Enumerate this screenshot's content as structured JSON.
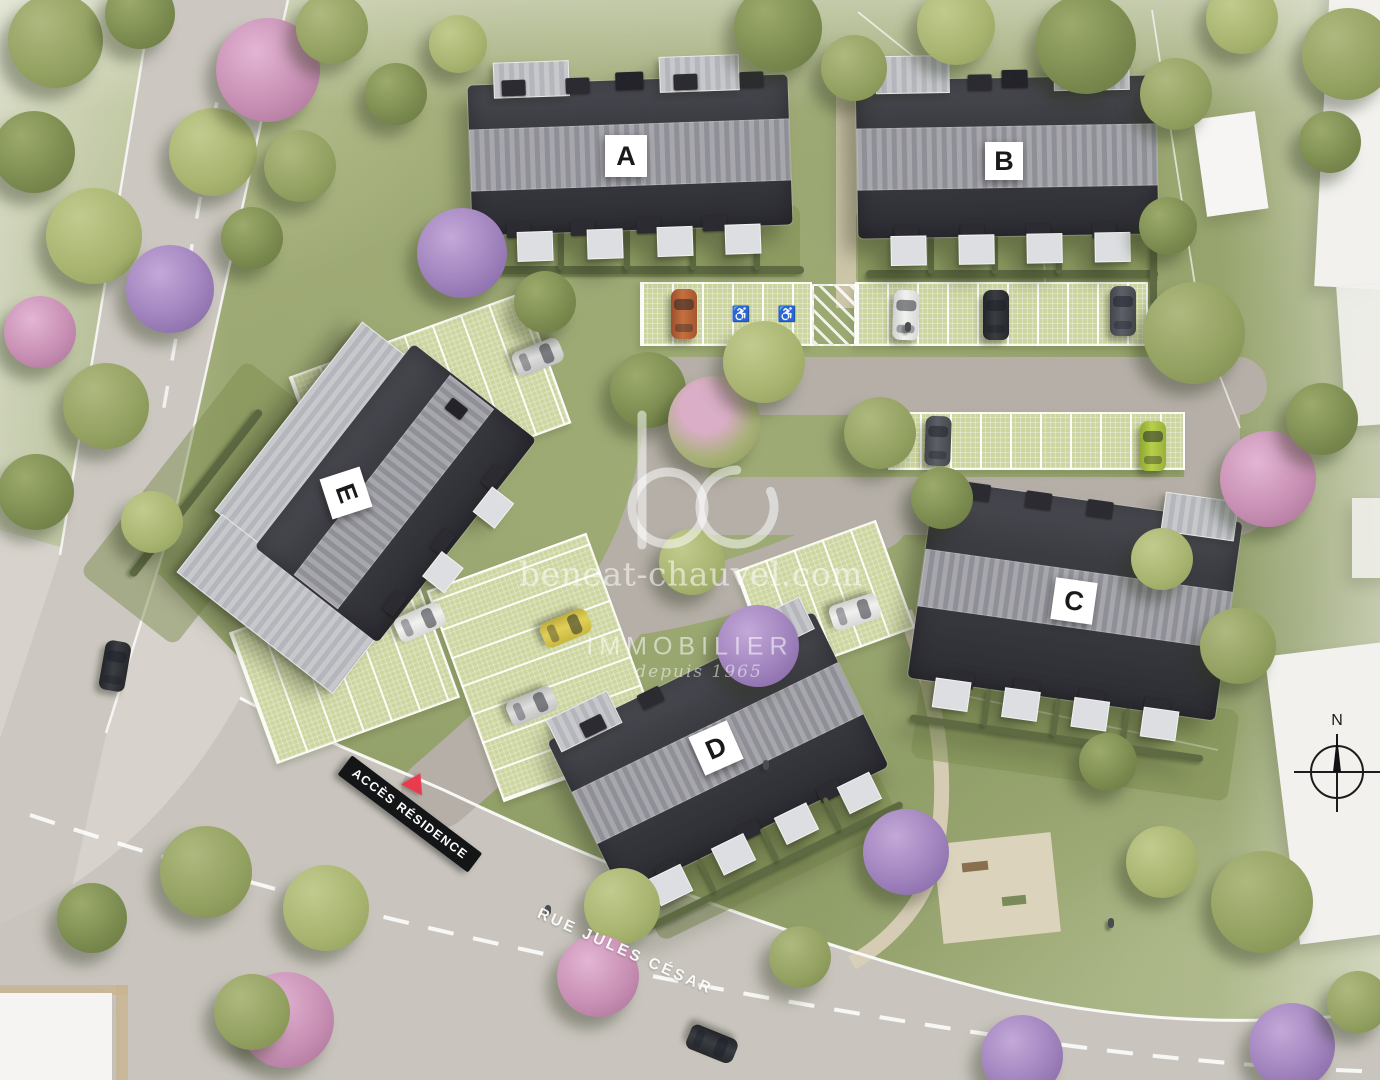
{
  "watermark": {
    "logo_icon": "bc-monogram-icon",
    "domain": "beneat-chauvel.com",
    "brand": "IMMOBILIER",
    "tagline": "depuis 1965"
  },
  "signs": {
    "access": "ACCÈS RÉSIDENCE",
    "street": "RUE JULES CÉSAR",
    "north": "N"
  },
  "buildings": [
    {
      "label": "A"
    },
    {
      "label": "B"
    },
    {
      "label": "C"
    },
    {
      "label": "D"
    },
    {
      "label": "E"
    }
  ],
  "icons": {
    "disabled_parking_glyph": "♿"
  },
  "colors": {
    "grass": "#9aa873",
    "road": "#c9c5be",
    "drive": "#b5afa7",
    "parking_green": "#cdd5a0",
    "roof_dark": "#3b3b42",
    "roof_ridge": "#a0a0a7",
    "label_bg": "#ffffff",
    "label_text": "#191a1c",
    "sign_bg": "#141517",
    "sign_text": "#ffffff",
    "access_triangle": "#e83c4e",
    "street_text": "#ffffff",
    "watermark_white": "rgba(255,255,255,0.55)",
    "offsite_building": "#f2f1ee",
    "hedge": "#5d6a42"
  }
}
